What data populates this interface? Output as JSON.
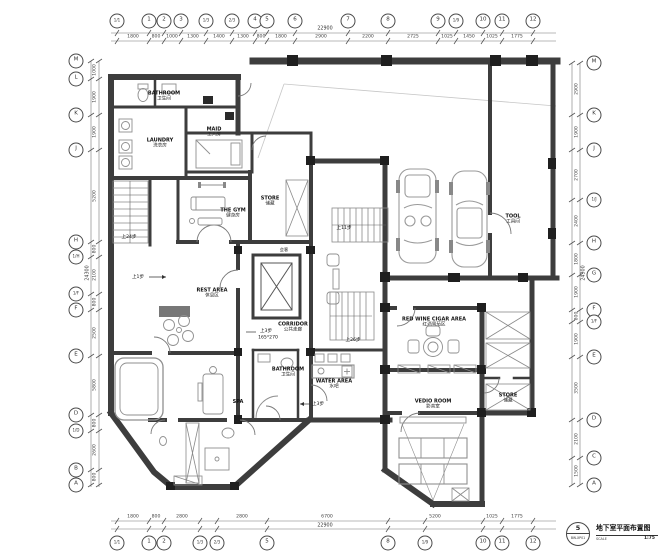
{
  "title_block": {
    "sheet_no": "5",
    "drawing_no": "BW-XP01",
    "title": "地下室平面布置图",
    "scale_label": "SCALE",
    "scale_value": "1:75"
  },
  "grid": {
    "top": {
      "bubbles": [
        "1/1",
        "1",
        "2",
        "3",
        "1/3",
        "2/3",
        "4",
        "5",
        "6",
        "7",
        "8",
        "9",
        "1/9",
        "10",
        "11",
        "12"
      ],
      "dims": [
        "1800",
        "800",
        "1000",
        "1300",
        "1400",
        "1300",
        "800",
        "1800",
        "2900",
        "2200",
        "2725",
        "1025",
        "1450",
        "1025",
        "1775"
      ],
      "total": "22900"
    },
    "bottom": {
      "bubbles": [
        "1/1",
        "1",
        "2",
        "1/3",
        "2/3",
        "5",
        "8",
        "1/9",
        "10",
        "11",
        "12"
      ],
      "dims": [
        "1800",
        "800",
        "2800",
        "2800",
        "6700",
        "5200",
        "1025",
        "1775"
      ],
      "total": "22900"
    },
    "left": {
      "bubbles": [
        "M",
        "L",
        "K",
        "J",
        "H",
        "1/H",
        "1/F",
        "F",
        "E",
        "D",
        "1/D",
        "B",
        "A"
      ],
      "dims": [
        "1000",
        "1900",
        "1900",
        "5200",
        "800",
        "2100",
        "800",
        "2500",
        "5800",
        "800",
        "2600",
        "800"
      ],
      "total": "24300"
    },
    "right": {
      "bubbles": [
        "M",
        "K",
        "J",
        "1/J",
        "H",
        "G",
        "F",
        "1/F",
        "E",
        "D",
        "C",
        "A"
      ],
      "dims": [
        "2900",
        "1900",
        "2700",
        "2400",
        "1800",
        "1900",
        "800",
        "1900",
        "3500",
        "2100",
        "1500"
      ],
      "total": "24300"
    }
  },
  "rooms": {
    "bathroom_top": {
      "en": "BATHROOM",
      "zh": "卫生间"
    },
    "laundry": {
      "en": "LAUNDRY",
      "zh": "洗衣房"
    },
    "maid": {
      "en": "MAID",
      "zh": "工人房"
    },
    "gym": {
      "en": "THE GYM",
      "zh": "健身房"
    },
    "store_left": {
      "en": "STORE",
      "zh": "储藏"
    },
    "rest_area": {
      "en": "REST AREA",
      "zh": "休息区"
    },
    "corridor": {
      "en": "CORRIDOR",
      "zh": "公共走廊"
    },
    "spa": {
      "en": "SPA"
    },
    "bathroom_mid": {
      "en": "BATHROOM",
      "zh": "卫生间"
    },
    "water_area": {
      "en": "WATER AREA",
      "zh": "水吧"
    },
    "red_wine": {
      "en": "RED WINE CIGAR AREA",
      "zh": "红酒雪茄区"
    },
    "video_room": {
      "en": "VEDIO ROOM",
      "zh": "影音室"
    },
    "store_right": {
      "en": "STORE",
      "zh": "储藏"
    },
    "tool": {
      "en": "TOOL",
      "zh": "工具间"
    },
    "meeting": {
      "zh": "会客"
    }
  },
  "annotations": {
    "steps_1": "上1步",
    "steps_3": "上3步",
    "dim_165": "165*270",
    "steps_11": "上11步",
    "steps_24": "上24步",
    "steps_26": "上26步",
    "steps_3b": "上3步"
  }
}
